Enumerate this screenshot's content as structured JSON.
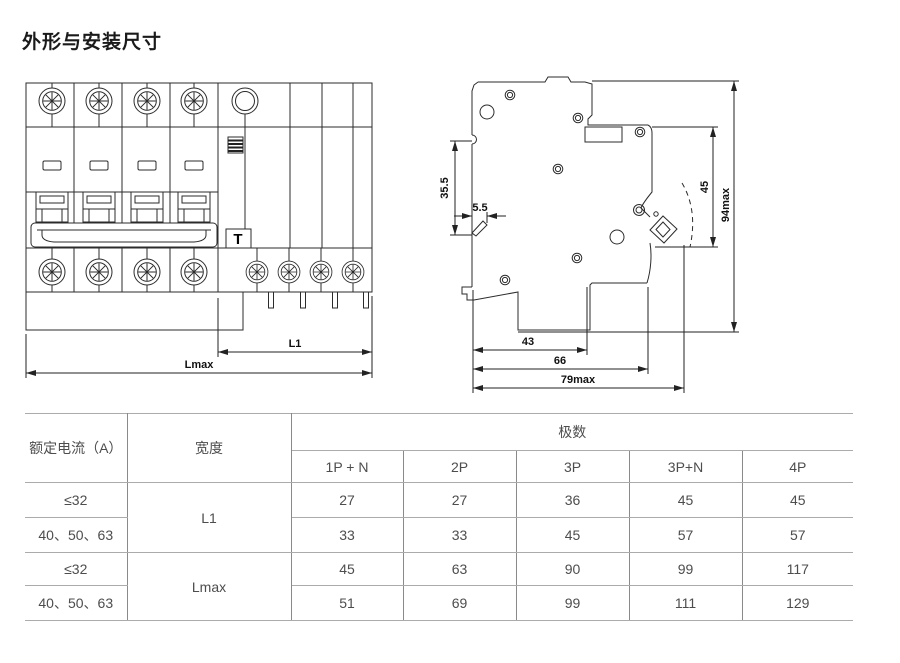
{
  "page": {
    "title": "外形与安装尺寸"
  },
  "front_view": {
    "test_button_label": "T",
    "dims": {
      "l1": "L1",
      "lmax": "Lmax"
    }
  },
  "side_view": {
    "dims": {
      "d35_5": "35.5",
      "d5_5": "5.5",
      "d45": "45",
      "d94max": "94max",
      "d43": "43",
      "d66": "66",
      "d79max": "79max"
    }
  },
  "table": {
    "col1_header": "额定电流（A）",
    "col2_header": "宽度",
    "poles_header": "极数",
    "pole_columns": [
      "1P + N",
      "2P",
      "3P",
      "3P+N",
      "4P"
    ],
    "rows": [
      {
        "current": "≤32",
        "width": "L1",
        "values": [
          27,
          27,
          36,
          45,
          45
        ]
      },
      {
        "current": "40、50、63",
        "width": "",
        "values": [
          33,
          33,
          45,
          57,
          57
        ]
      },
      {
        "current": "≤32",
        "width": "Lmax",
        "values": [
          45,
          63,
          90,
          99,
          117
        ]
      },
      {
        "current": "40、50、63",
        "width": "",
        "values": [
          51,
          69,
          99,
          111,
          129
        ]
      }
    ]
  }
}
